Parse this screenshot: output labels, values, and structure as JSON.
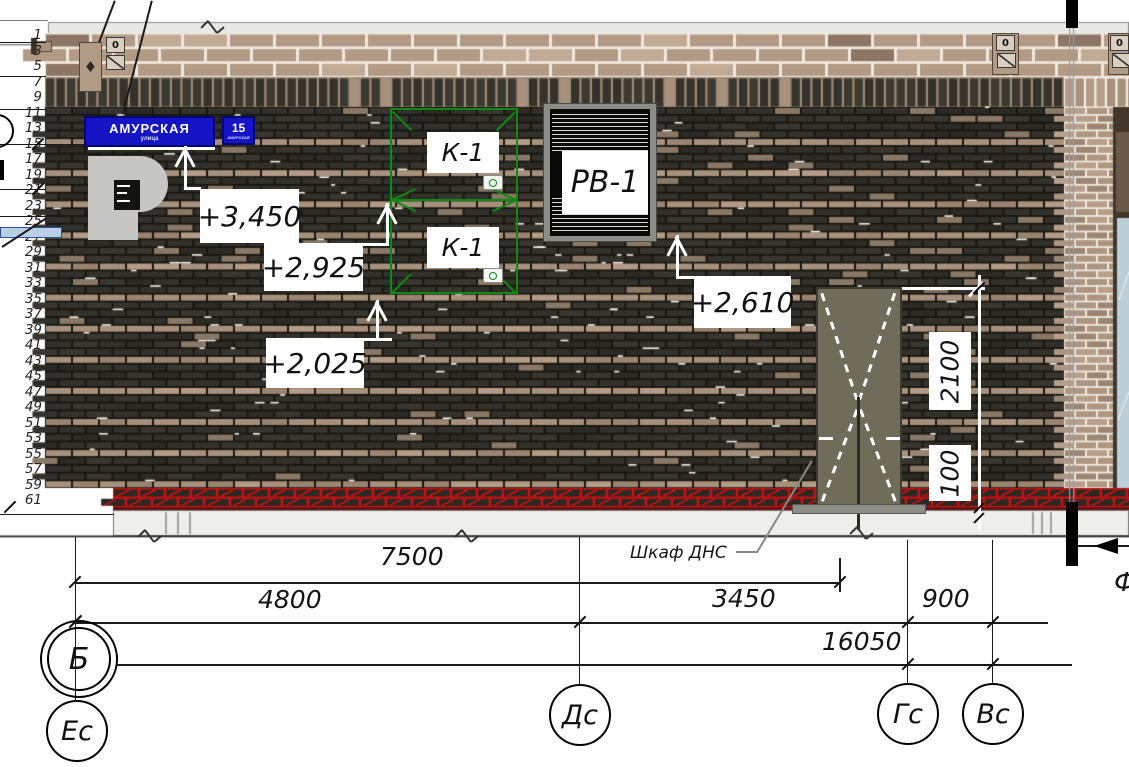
{
  "course_numbers": [
    "1",
    "3",
    "5",
    "7",
    "9",
    "11",
    "13",
    "15",
    "17",
    "19",
    "21",
    "23",
    "25",
    "27",
    "29",
    "31",
    "33",
    "35",
    "37",
    "39",
    "41",
    "43",
    "45",
    "47",
    "49",
    "51",
    "53",
    "55",
    "57",
    "59",
    "61"
  ],
  "signs": {
    "street": {
      "name": "АМУРСКАЯ",
      "sub": "улица"
    },
    "house": {
      "number": "15",
      "sub": "АМУРСКАЯ"
    }
  },
  "component_labels": {
    "k1_top": "К-1",
    "k1_bottom": "К-1",
    "vent": "РВ-1",
    "cabinet": "Шкаф ДНС"
  },
  "elevation_marks": [
    {
      "value": "+3,450"
    },
    {
      "value": "+2,925"
    },
    {
      "value": "+2,025"
    },
    {
      "value": "+2,610"
    }
  ],
  "dimensions": {
    "d7500": "7500",
    "d4800": "4800",
    "d3450": "3450",
    "d900": "900",
    "d16050": "16050",
    "v2100": "2100",
    "v100": "100"
  },
  "axes": {
    "row": "Б",
    "col1": "Ес",
    "col2": "Дс",
    "col3": "Гс",
    "col4": "Вс",
    "col5": "Ф"
  },
  "markers": {
    "left_zero": "0",
    "right_zero_1": "0",
    "right_zero_2": "0"
  },
  "colors": {
    "brick_dark": "#34322c",
    "brick_tan": "#b49b85",
    "accent_blue": "#1414c4",
    "marking_green": "#0c8a12",
    "base_red": "#e01010",
    "glass": "#bccfd8",
    "cabinet": "#6f6c5a"
  }
}
